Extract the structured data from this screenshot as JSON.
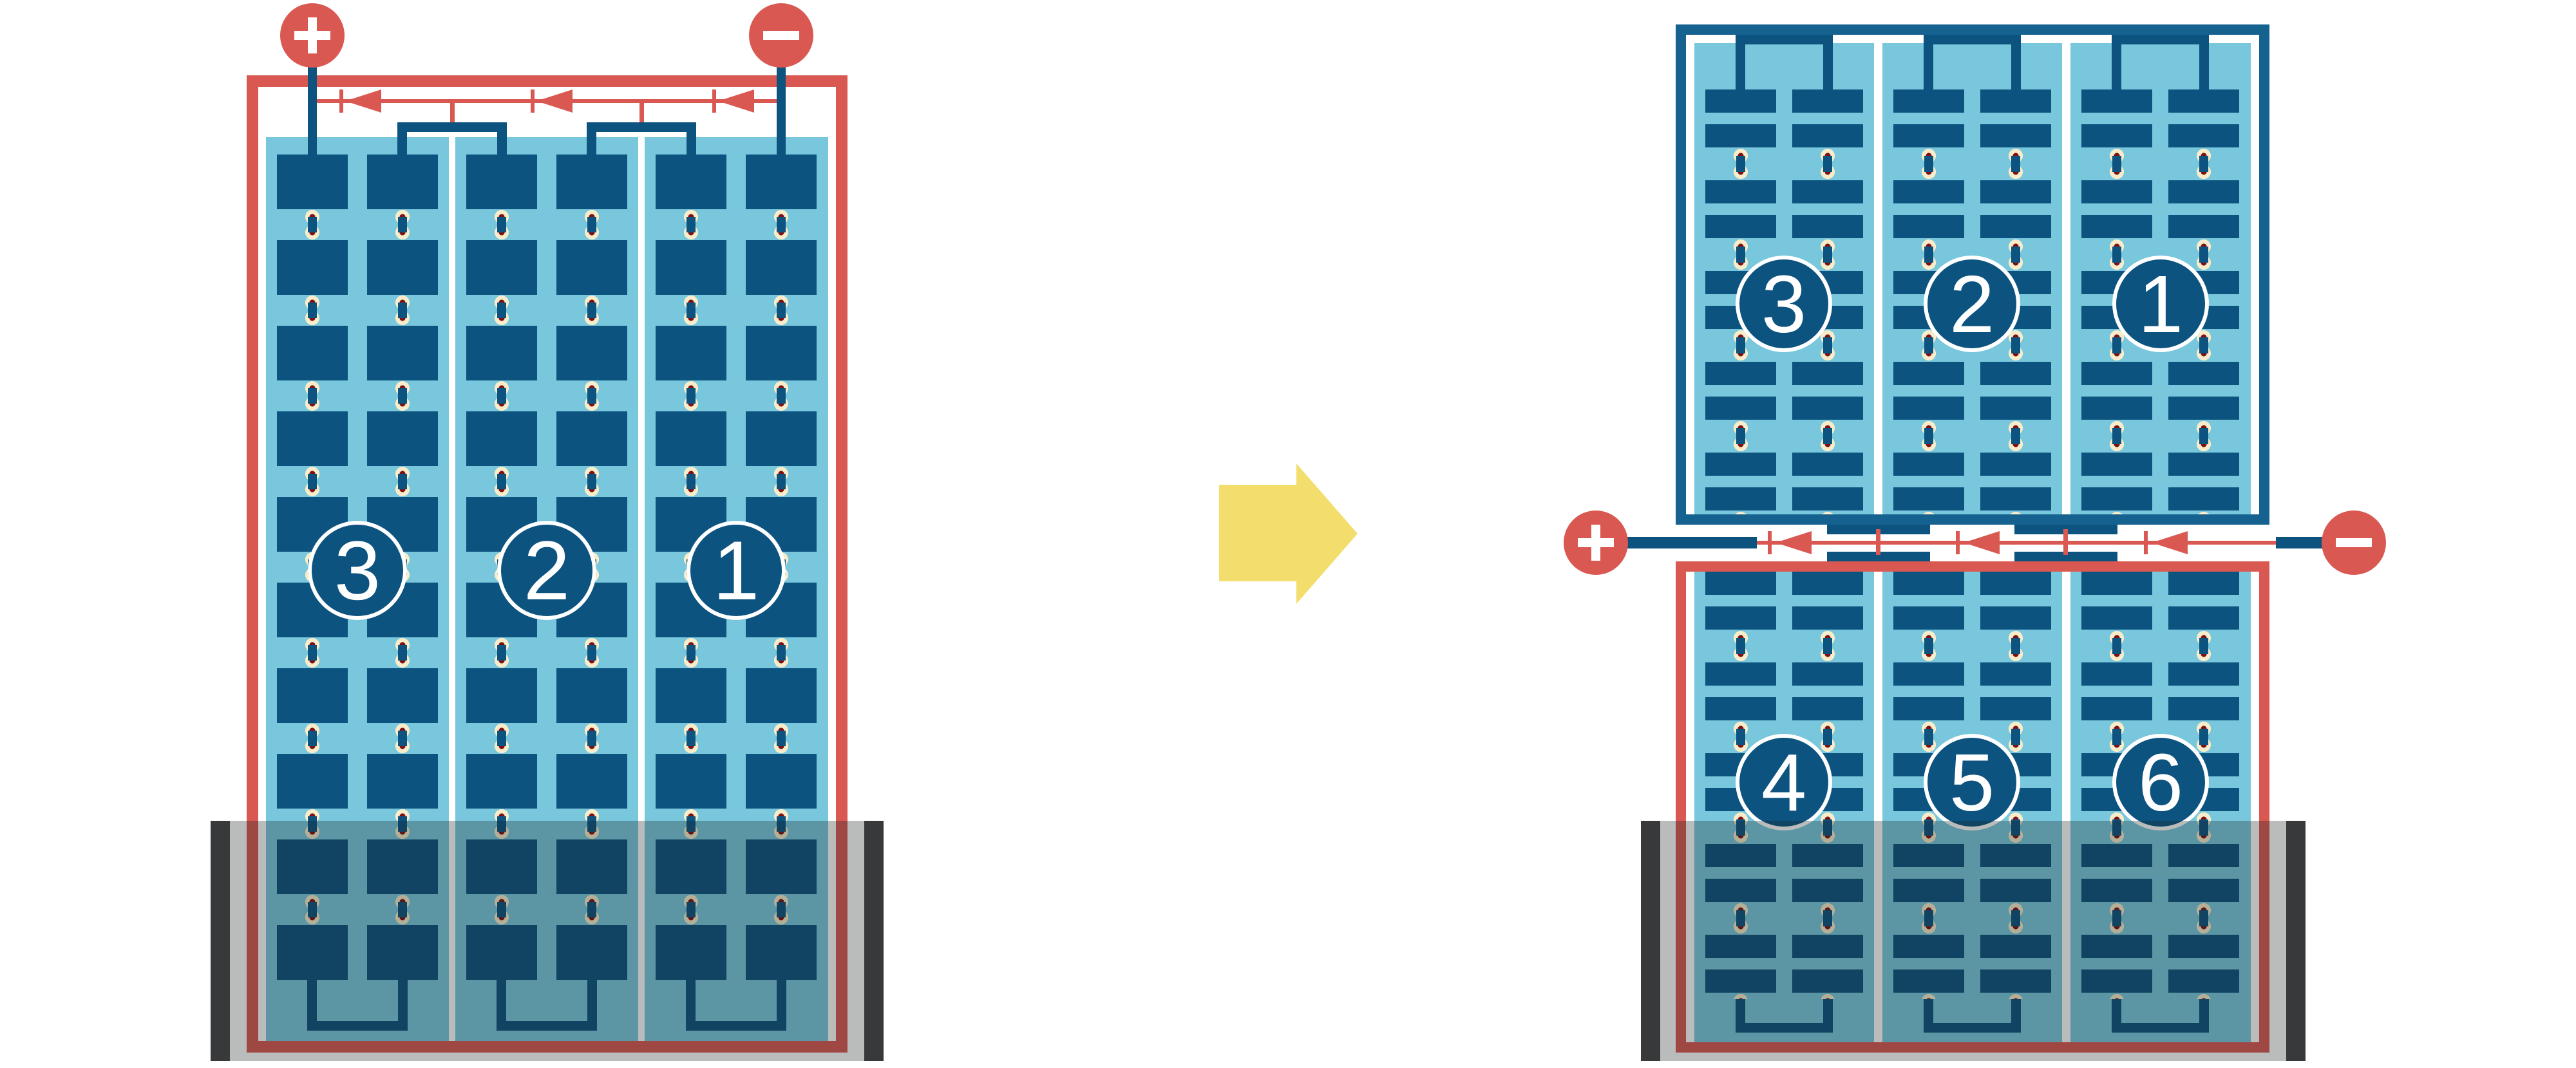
{
  "left_module": {
    "description": "full-cell module, three series cell strings, lower part shaded",
    "badges": [
      "3",
      "2",
      "1"
    ],
    "terminal_plus": "+",
    "terminal_minus": "−",
    "columns": 3,
    "bypass_diodes": 3
  },
  "right_module": {
    "description": "half-cut cell module, six strings in two halves, lower part shaded",
    "top_badges": [
      "3",
      "2",
      "1"
    ],
    "bottom_badges": [
      "4",
      "5",
      "6"
    ],
    "terminal_plus": "+",
    "terminal_minus": "−",
    "bypass_diodes": 3
  },
  "transform_arrow": "right",
  "icons": {
    "plus-terminal": "plus-circle",
    "minus-terminal": "minus-circle",
    "bypass-diode": "left-pointing-diode",
    "transform-arrow": "right-block-arrow",
    "shade": "shadow-band-with-dark-edges"
  },
  "colors": {
    "wiring_red": "#D95952",
    "cell_navy": "#0D5380",
    "panel_light_blue": "#79C7DC",
    "top_frame_blue": "#15618F",
    "solder_cream": "#F8ECCA",
    "solder_maroon": "#7F1113",
    "arrow_yellow": "#F3DD6C",
    "shade_bar_dark": "#37393B"
  }
}
